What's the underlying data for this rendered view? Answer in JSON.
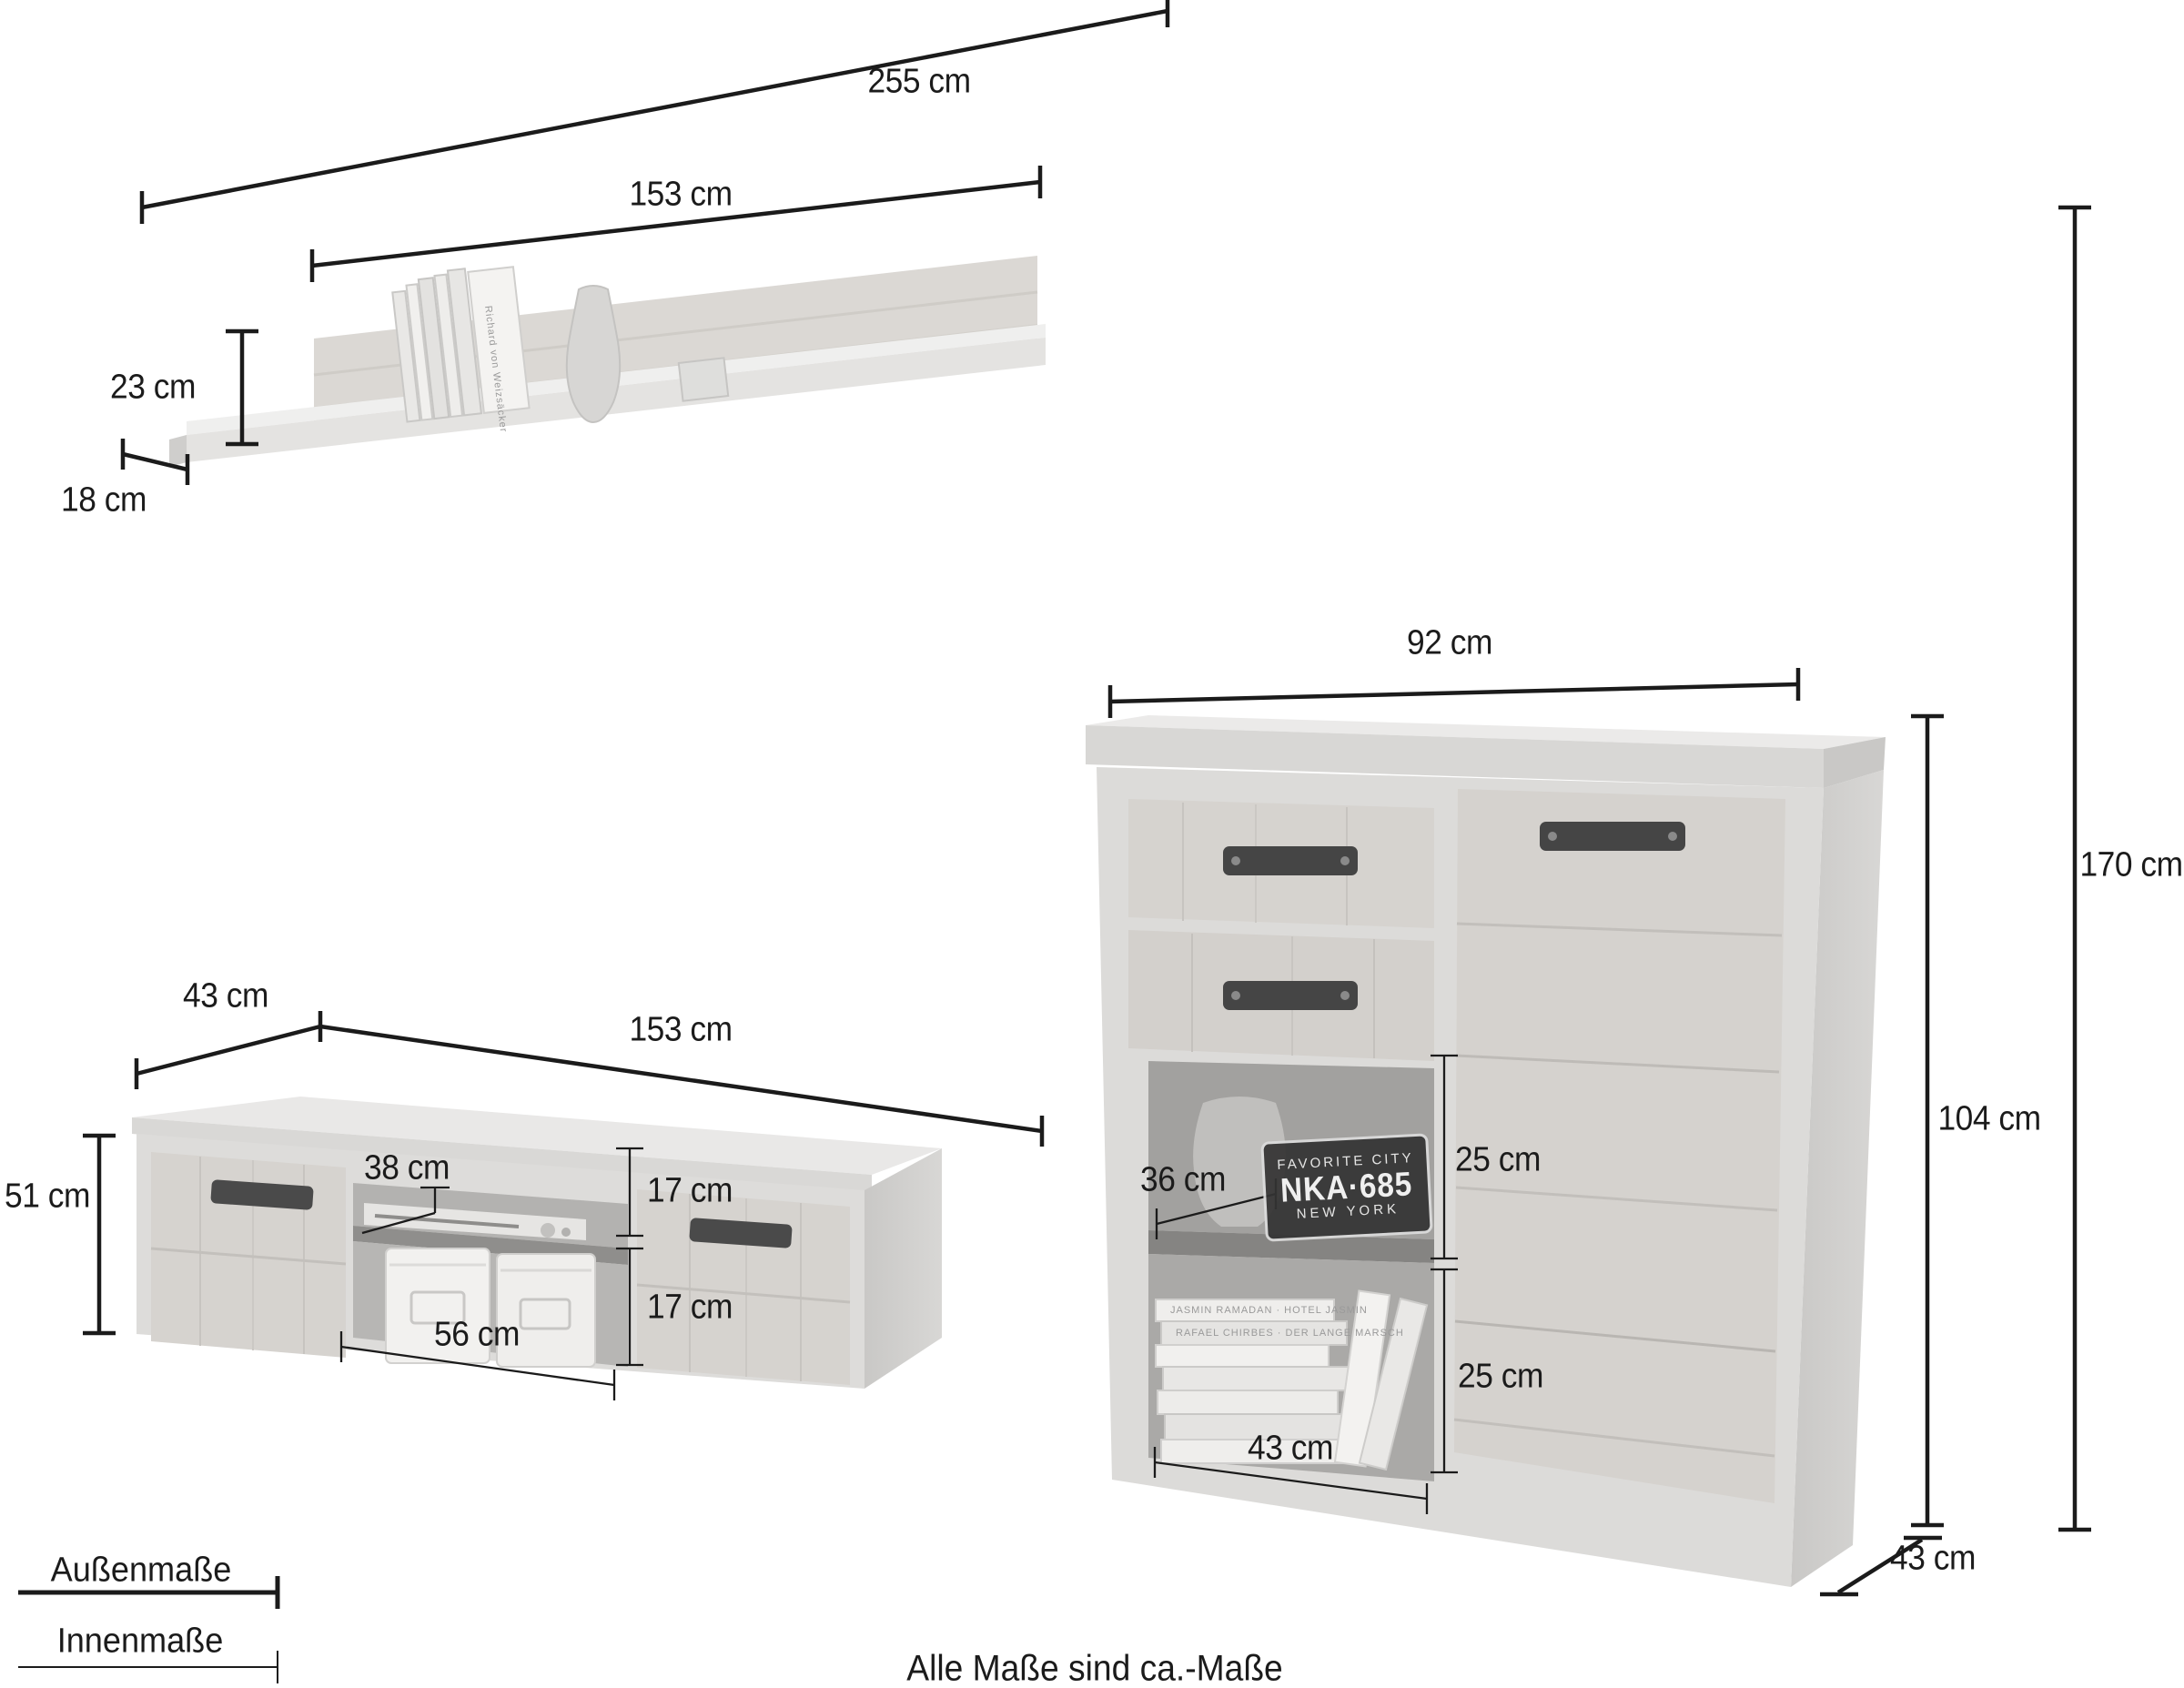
{
  "note": "Alle Maße sind ca.-Maße",
  "legend": {
    "outer_label": "Außenmaße",
    "inner_label": "Innenmaße"
  },
  "dimensions": {
    "total_width": "255 cm",
    "total_height": "170 cm",
    "shelf_width": "153 cm",
    "shelf_height": "23 cm",
    "shelf_depth": "18 cm",
    "lowboard_depth": "43 cm",
    "lowboard_width": "153 cm",
    "lowboard_height": "51 cm",
    "lowboard_inner_top_width": "38 cm",
    "lowboard_inner_upper_height": "17 cm",
    "lowboard_inner_lower_height": "17 cm",
    "lowboard_inner_bottom_width": "56 cm",
    "highboard_width": "92 cm",
    "highboard_height": "104 cm",
    "highboard_depth": "43 cm",
    "highboard_inner_width": "36 cm",
    "highboard_inner_upper_height": "25 cm",
    "highboard_inner_lower_height": "25 cm",
    "highboard_inner_bottom_width": "43 cm"
  },
  "license_plate": {
    "top_text": "FAVORITE CITY",
    "number": "NKA·685",
    "bottom_text": "NEW YORK"
  },
  "photo_texts": {
    "shelf_book": "Richard von Weizsäcker",
    "book_spine_1": "JASMIN RAMADAN · HOTEL JASMIN",
    "book_spine_2": "RAFAEL CHIRBES · DER LANGE MARSCH"
  },
  "colors": {
    "line": "#1b1b1b",
    "text": "#1b1b1b",
    "furniture_light": "#e0dfdd",
    "wood": "#d6d3cf",
    "interior": "#aeaeae",
    "plate_bg": "#333333",
    "plate_text": "#f6f6f6"
  }
}
